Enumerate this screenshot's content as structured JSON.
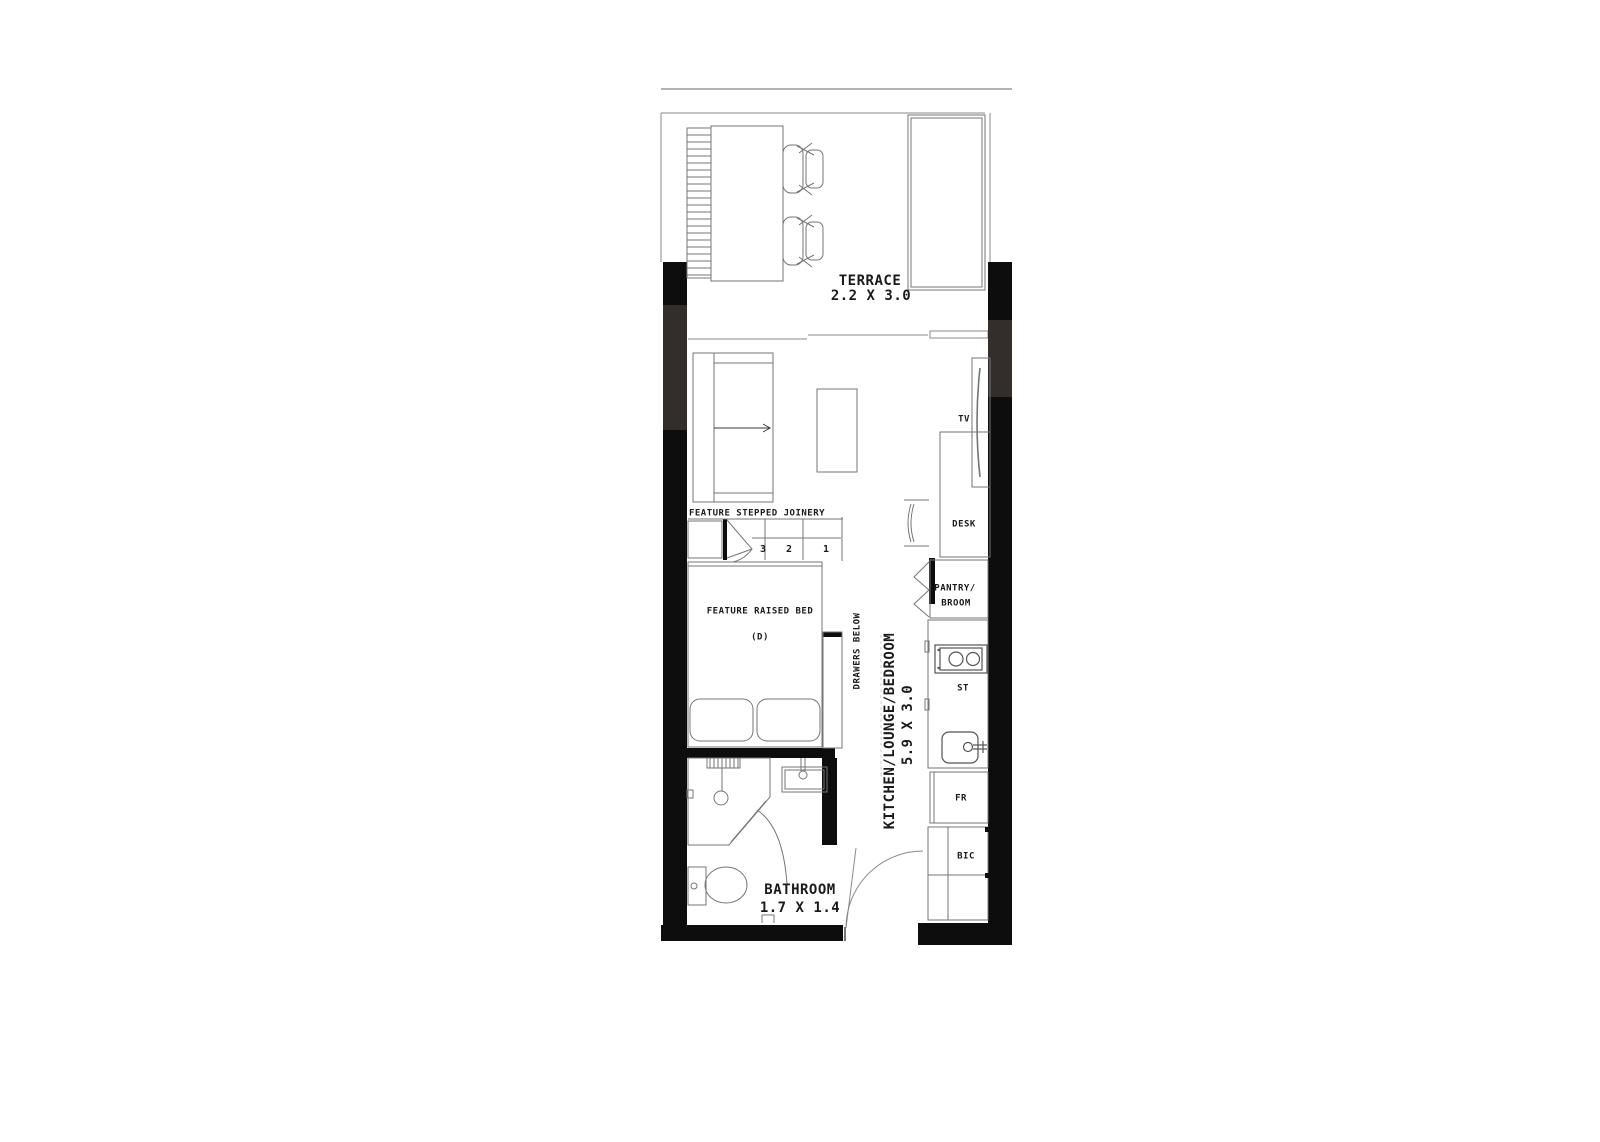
{
  "plan": {
    "terrace": {
      "name": "TERRACE",
      "dims": "2.2 X 3.0"
    },
    "living": {
      "name": "KITCHEN/LOUNGE/BEDROOM",
      "dims": "5.9 X 3.0"
    },
    "bathroom": {
      "name": "BATHROOM",
      "dims": "1.7 X 1.4"
    },
    "labels": {
      "tv": "TV",
      "desk": "DESK",
      "pantry_line1": "PANTRY/",
      "pantry_line2": "BROOM",
      "stove": "ST",
      "fridge": "FR",
      "built_in_cupboard": "BIC",
      "drawers": "DRAWERS BELOW",
      "stepped_joinery": "FEATURE STEPPED JOINERY",
      "raised_bed": "FEATURE RAISED BED",
      "bed_type": "(D)"
    },
    "steps": [
      "3",
      "2",
      "1"
    ],
    "colors": {
      "wall": "#0d0d0d",
      "window_band": "#332e2b",
      "line": "#757575",
      "text": "#1a1a1a",
      "background": "#ffffff"
    }
  }
}
